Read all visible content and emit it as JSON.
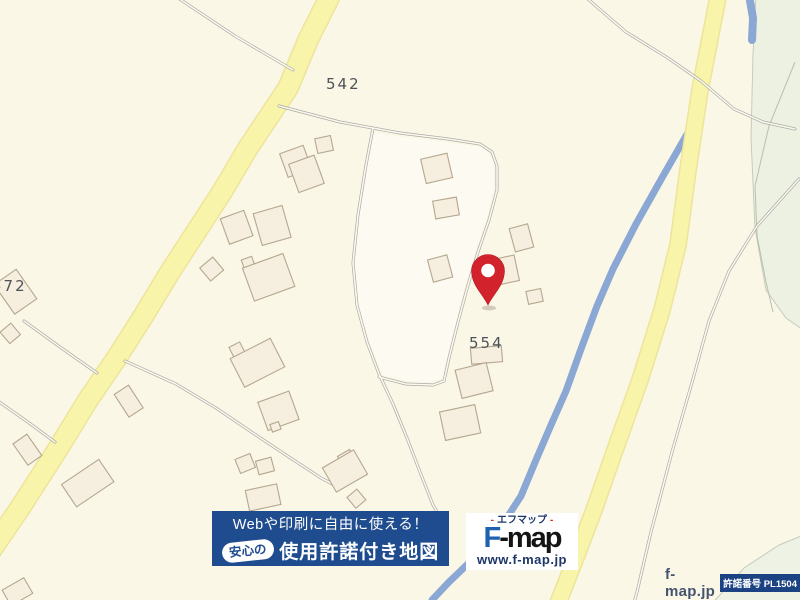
{
  "map": {
    "parcel_labels": {
      "n542": "542",
      "n554": "554",
      "n572": "572"
    },
    "marker": {
      "name": "location-pin",
      "color": "#D2232C"
    }
  },
  "promo_banner": {
    "line1": "Webや印刷に自由に使える！",
    "badge": "安心の",
    "line2": "使用許諾付き地図"
  },
  "logo": {
    "subtitle_prefix": "-",
    "subtitle_text": "エフマップ",
    "subtitle_suffix": "-",
    "wordmark_f": "F",
    "wordmark_rest": "-map",
    "url": "www.f-map.jp"
  },
  "attribution": {
    "site": "f-map.jp",
    "license": "許諾番号 PL1504",
    "copyright": "©GeoTechnologies, Inc."
  },
  "colors": {
    "background": "#FBF7E7",
    "road_yellow": "#F8F4AA",
    "river_blue": "#8BA7D4",
    "forest_green": "#ECF1E2",
    "building_fill": "#F6EEDE",
    "banner_blue": "#1E4C8E",
    "logo_blue": "#1D62B0",
    "pin_red": "#D2232C",
    "accent_red": "#D9271E"
  }
}
